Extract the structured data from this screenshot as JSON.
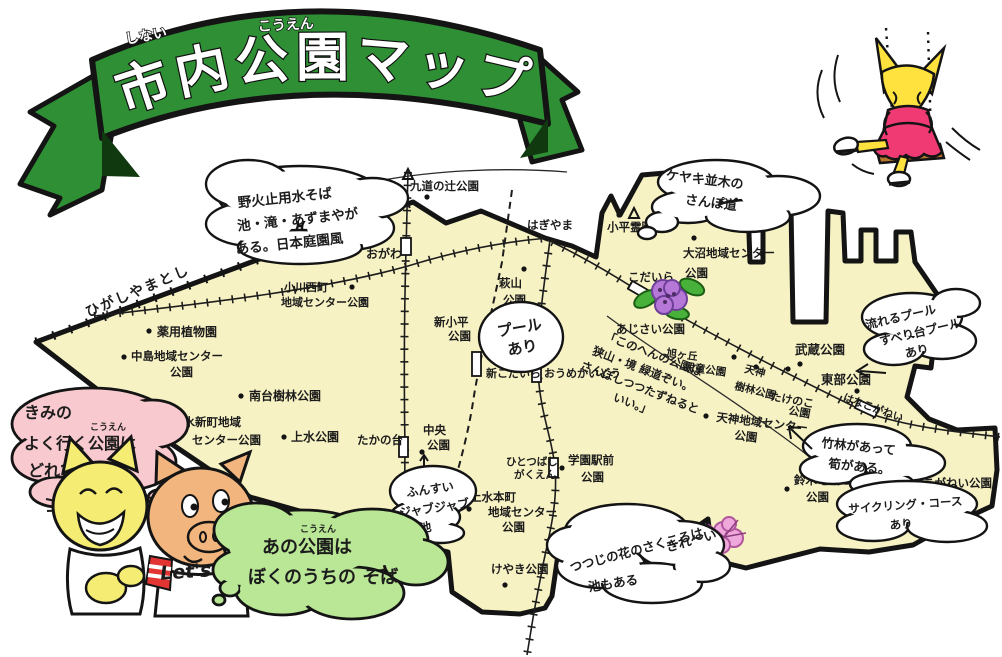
{
  "title": {
    "main": "市内公園マップ",
    "furigana_left": "しない",
    "furigana_right": "こうえん"
  },
  "boundary_label": "ひがしやまとし",
  "note_sayama": [
    "「このへんの公園は",
    "狭山・境 緑道ぞい。",
    "さんぽしつつたずねると",
    "いい。」"
  ],
  "bubbles": {
    "nobidome": [
      "野火止用水そば",
      "池・滝・あずまやが",
      "ある。日本庭園風"
    ],
    "keyaki_namiki": [
      "ケヤキ並木の",
      "さんぽ道"
    ],
    "pool": [
      "プール",
      "あり"
    ],
    "nagareru_pool": [
      "流れるプール",
      "すべり台プール",
      "あり"
    ],
    "chikurin": [
      "竹林があって",
      "筍がある。"
    ],
    "funsui": [
      "ふんすい",
      "ジャブジャブ",
      "池"
    ],
    "tsutsuji": [
      "つつじの花のさくころは",
      "きれ〜い",
      "池もある"
    ],
    "cycling": [
      "サイクリング・コース",
      "あり"
    ],
    "cat_question": [
      "きみの",
      "よく行く公園は",
      "どれ?"
    ],
    "cat_question_furigana": "こうえん",
    "pig_answer": [
      "あの公園は",
      "ぼくのうちの そば"
    ],
    "pig_answer_furigana": "こうえん"
  },
  "stations": {
    "ogawa": "おがわ",
    "hagiyama": "はぎやま",
    "shin_kodaira": "新こだいら",
    "oume_kaido": "おうめかいどう",
    "kodaira": "こだいら",
    "takanodai": "たかの台",
    "hitotsubashi": [
      "ひとつばし",
      "がくえん"
    ],
    "hana_koganei": "はなこがねい"
  },
  "parks": {
    "kudo_no_tsuji": [
      "九道の辻公園"
    ],
    "nakajuku": [
      "仲宿児童",
      "公園"
    ],
    "ogawa_nishi": [
      "小川西町",
      "地域センター公園"
    ],
    "yakuyo": [
      "薬用植物園"
    ],
    "nakajima": [
      "中島地域センター",
      "公園"
    ],
    "minamidai": [
      "南台樹林公園"
    ],
    "josui_shinmachi": [
      "上水新町地域",
      "センター公園"
    ],
    "josui": [
      "上水公園"
    ],
    "chuo": [
      "中央",
      "公園"
    ],
    "shin_kodaira": [
      "新小平",
      "公園"
    ],
    "hagiyama": [
      "萩山",
      "公園"
    ],
    "kodaira_reien": [
      "小平霊園"
    ],
    "onuma": [
      "大沼地域センター",
      "公園"
    ],
    "ajisai": [
      "あじさい公園"
    ],
    "asahigaoka": [
      "旭ヶ丘",
      "児童公園"
    ],
    "tenjin_jurin": [
      "天神",
      "樹林公園"
    ],
    "takenoko": [
      "たけのこ",
      "公園"
    ],
    "tenjin_chiiki": [
      "天神地域センター",
      "公園"
    ],
    "musashi": [
      "武蔵公園"
    ],
    "tobu": [
      "東部公園"
    ],
    "suzuki": [
      "鈴木地域センター",
      "公園"
    ],
    "koganei": [
      "こがねい公園"
    ],
    "gakuen_ekimae": [
      "学園駅前",
      "公園"
    ],
    "josui_honcho": [
      "上水本町",
      "地域センター",
      "公園"
    ],
    "keyaki": [
      "けやき公園"
    ],
    "tsutsuji": [
      "つつじ公園"
    ]
  },
  "characters": {
    "pig_shirt": "Let's"
  },
  "colors": {
    "banner_green": "#2f8f35",
    "map_cream": "#f7f2c3",
    "bubble_pink": "#f8c9cf",
    "bubble_green": "#b9e795",
    "cat_yellow": "#f5ec74",
    "pig_tan": "#f2b57e",
    "swing_girl_yellow": "#ffe23d",
    "dress_pink": "#f03a74",
    "hydrangea_purple": "#b678d6",
    "azalea_pink": "#efa8db",
    "seat_brown": "#b5762c",
    "stripe_red": "#e33434"
  }
}
